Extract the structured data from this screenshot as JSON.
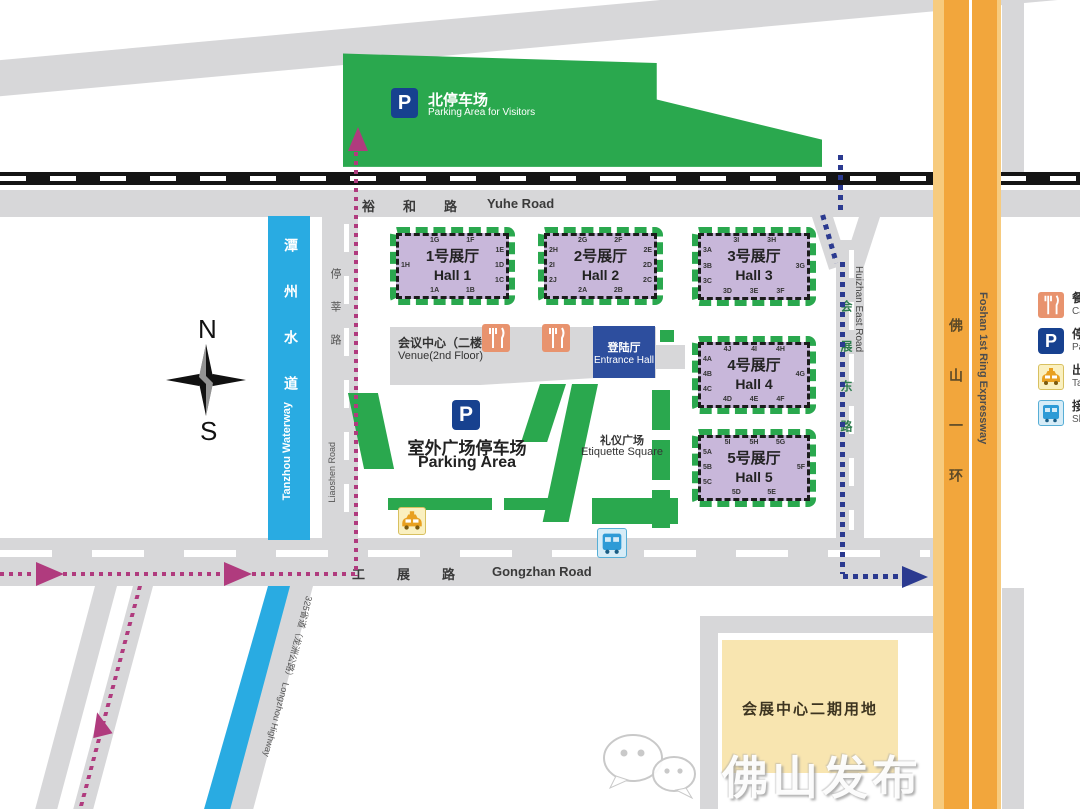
{
  "colors": {
    "green": "#2aa84e",
    "purple": "#c8b7da",
    "waterBlue": "#29abe2",
    "orange": "#f2a63c",
    "orangeLight": "#f7cb7e",
    "routePink": "#b03b7e",
    "routeBlue": "#2b3a90",
    "entranceBlue": "#2d4e9e",
    "navy": "#17418f",
    "phase2Yellow": "#f8e5b0",
    "catering": "#e8936e"
  },
  "map": {
    "north_parking": {
      "zh": "北停车场",
      "en": "Parking Area for Visitors"
    },
    "compass": {
      "n": "N",
      "s": "S"
    },
    "roads": {
      "yuhe": {
        "zh": "裕和路",
        "en": "Yuhe Road"
      },
      "gongzhan": {
        "zh": "工展路",
        "en": "Gongzhan Road"
      },
      "huizhan_east": {
        "zh": "会展东路",
        "en": "Huizhan East Road"
      },
      "liaoshen": {
        "zh": "停莘路",
        "en": "Liaoshen Road"
      },
      "foshan_ring": {
        "zh": "佛山一环",
        "en": "Foshan 1st Ring Expressway"
      },
      "longzhou": {
        "zh": "325省道（龙洲公路）",
        "en": "Longzhou Highway"
      }
    },
    "waterway": {
      "zh": "潭州水道",
      "en": "Tanzhou Waterway"
    },
    "halls": [
      {
        "zh": "1号展厅",
        "en": "Hall 1",
        "gates": {
          "top": [
            "1G",
            "1F"
          ],
          "right": [
            "1E",
            "1D",
            "1C"
          ],
          "bottom": [
            "1A",
            "1B"
          ],
          "left": [
            "1H"
          ]
        }
      },
      {
        "zh": "2号展厅",
        "en": "Hall 2",
        "gates": {
          "top": [
            "2G",
            "2F"
          ],
          "right": [
            "2E",
            "2D",
            "2C"
          ],
          "bottom": [
            "2A",
            "2B"
          ],
          "left": [
            "2H",
            "2I",
            "2J"
          ]
        }
      },
      {
        "zh": "3号展厅",
        "en": "Hall 3",
        "gates": {
          "top": [
            "3I",
            "3H"
          ],
          "right": [
            "3G"
          ],
          "bottom": [
            "3D",
            "3E",
            "3F"
          ],
          "left": [
            "3A",
            "3B",
            "3C"
          ]
        }
      },
      {
        "zh": "4号展厅",
        "en": "Hall 4",
        "gates": {
          "top": [
            "4J",
            "4I",
            "4H"
          ],
          "right": [
            "4G"
          ],
          "bottom": [
            "4D",
            "4E",
            "4F"
          ],
          "left": [
            "4A",
            "4B",
            "4C"
          ]
        }
      },
      {
        "zh": "5号展厅",
        "en": "Hall 5",
        "gates": {
          "top": [
            "5I",
            "5H",
            "5G"
          ],
          "right": [
            "5F"
          ],
          "bottom": [
            "5D",
            "5E"
          ],
          "left": [
            "5A",
            "5B",
            "5C"
          ]
        }
      }
    ],
    "venue": {
      "zh": "会议中心（二楼）",
      "en": "Venue(2nd Floor)"
    },
    "entrance_hall": {
      "zh": "登陆厅",
      "en": "Entrance Hall"
    },
    "etiquette_square": {
      "zh": "礼仪广场",
      "en": "Etiquette Square"
    },
    "outdoor_parking": {
      "zh": "室外广场停车场",
      "en": "Parking Area"
    },
    "phase2": {
      "zh": "会展中心二期用地"
    },
    "icons": {
      "parking_letter": "P"
    }
  },
  "legend": {
    "items": [
      {
        "icon": "catering-icon",
        "zh": "餐饮",
        "en": "Catering"
      },
      {
        "icon": "parking-icon",
        "zh": "停车场",
        "en": "Parking"
      },
      {
        "icon": "taxi-icon",
        "zh": "出租车",
        "en": "Taxi"
      },
      {
        "icon": "shuttle-bus-icon",
        "zh": "接驳巴士",
        "en": "Shuttle Bus"
      }
    ]
  },
  "watermark": {
    "text": "佛山发布"
  }
}
